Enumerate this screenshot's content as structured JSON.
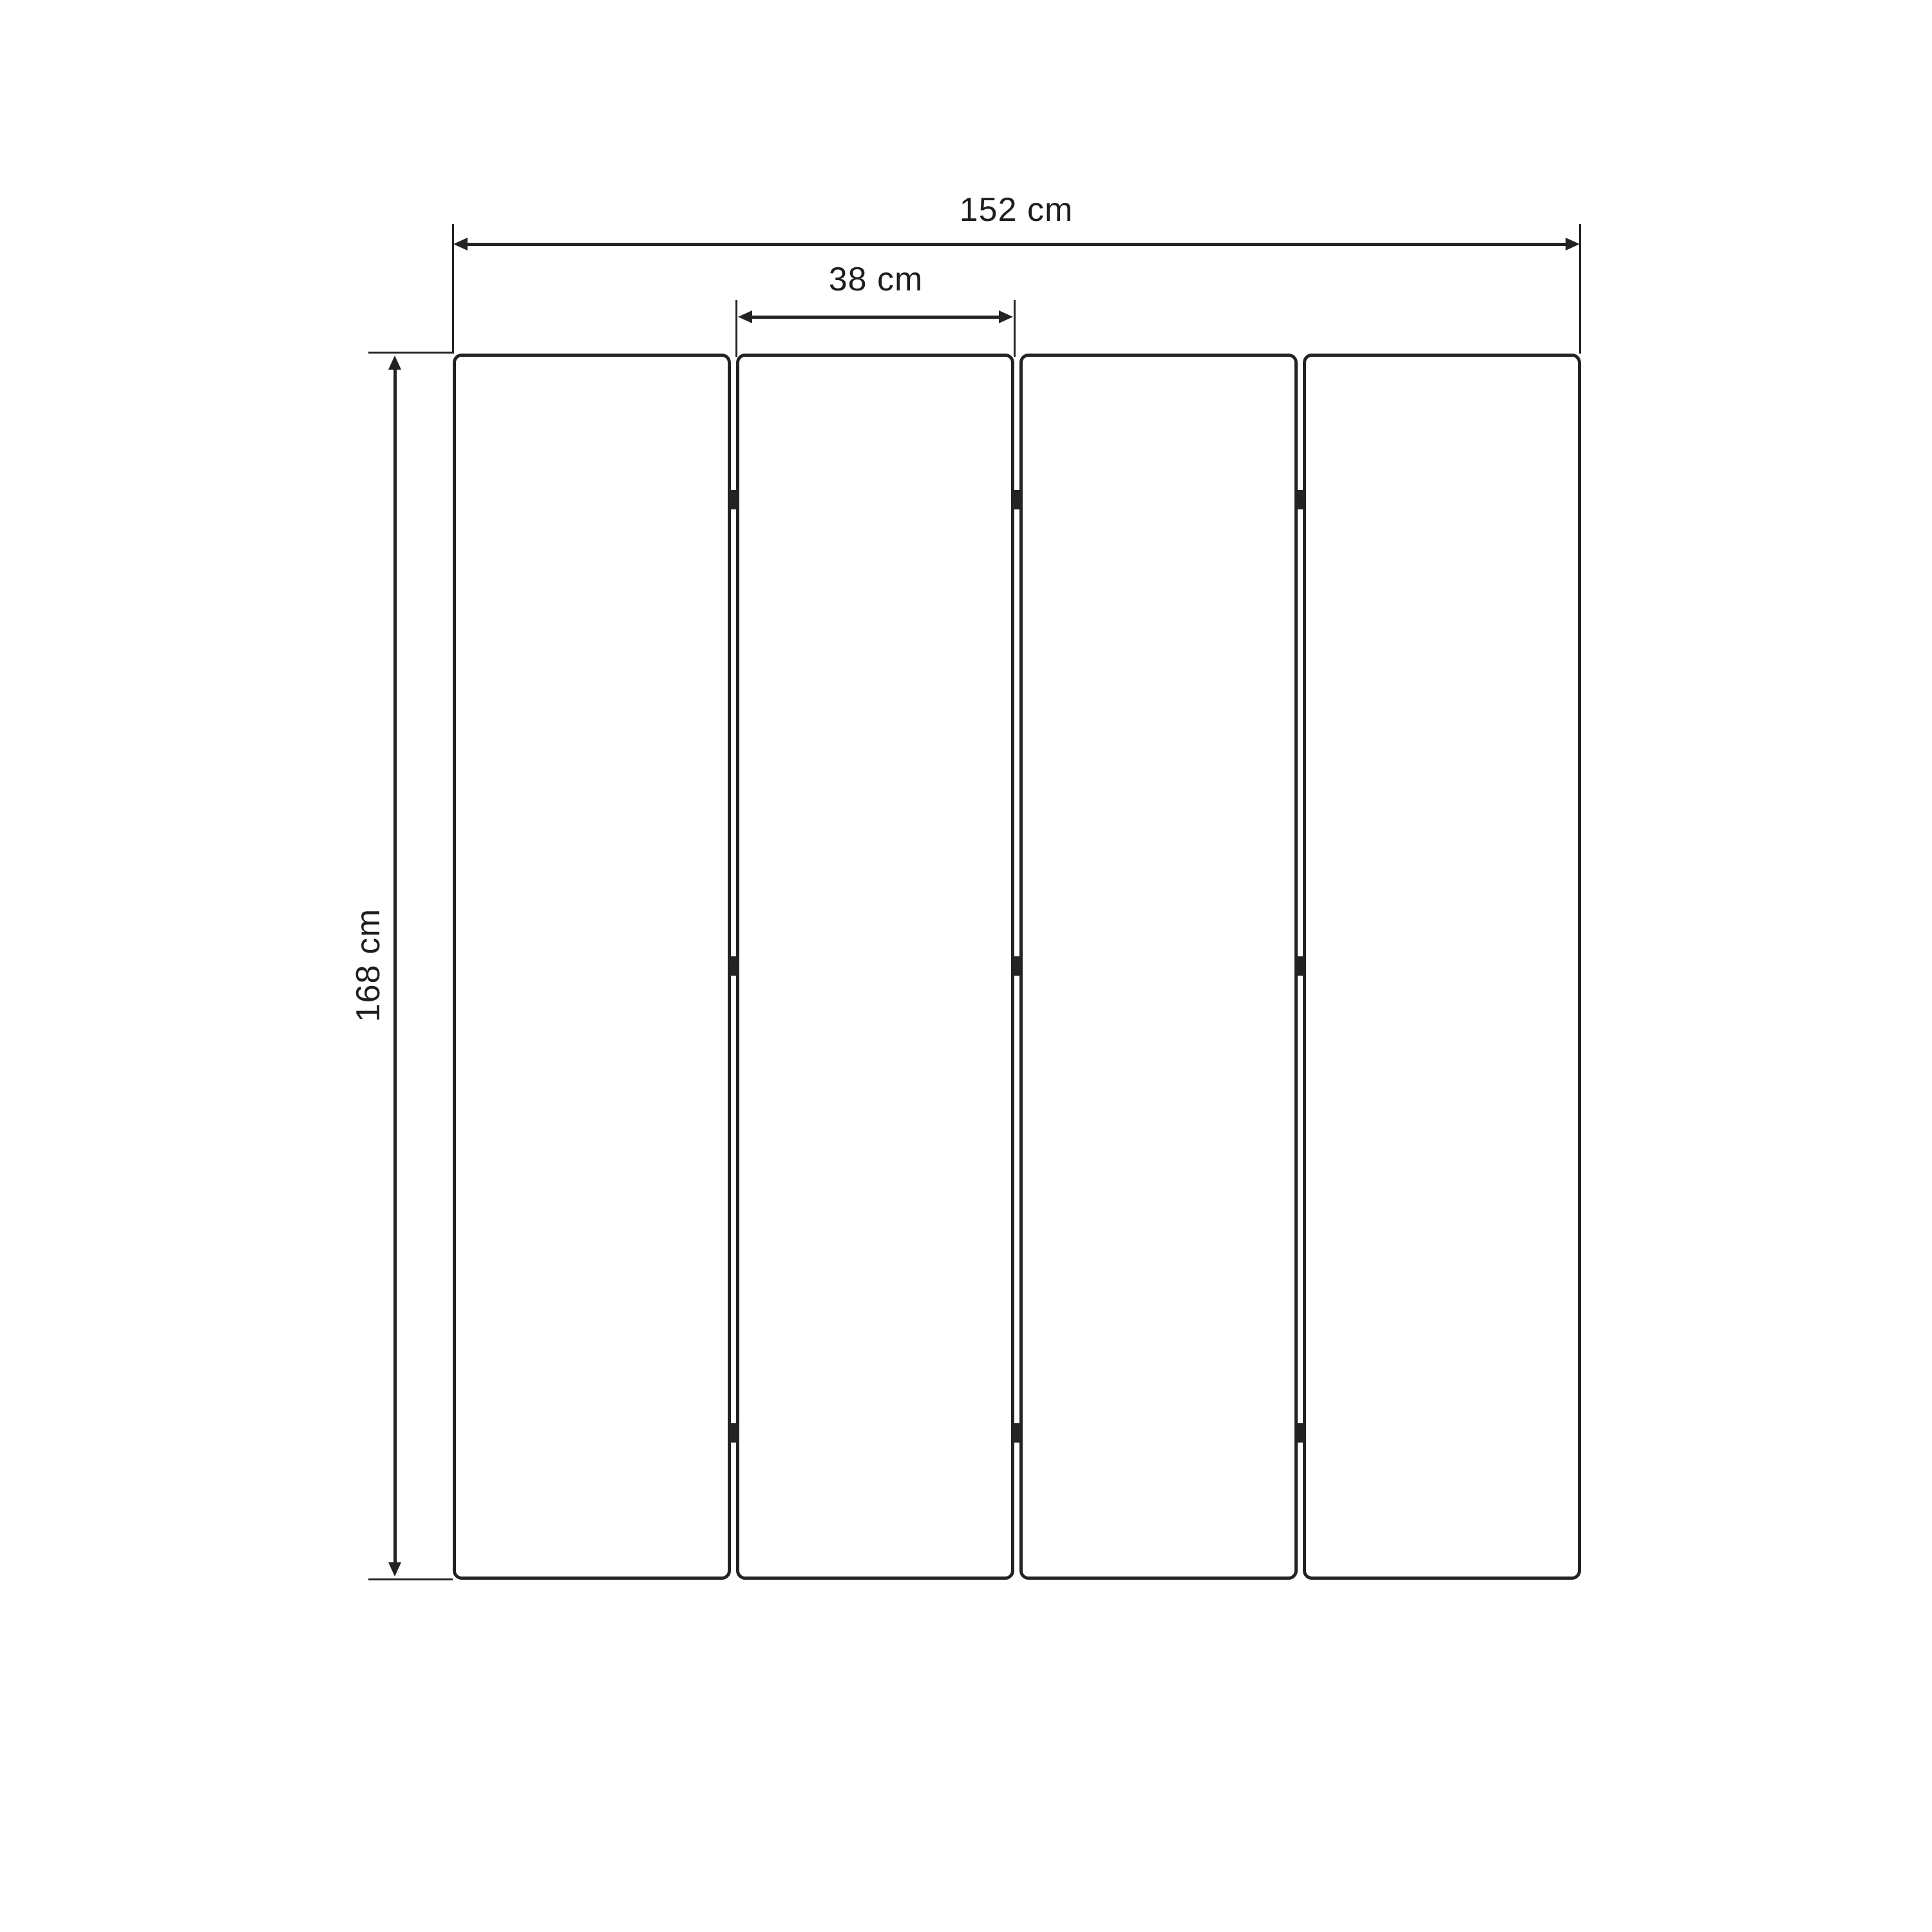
{
  "diagram": {
    "type": "furniture-dimension-drawing",
    "subject": "four-panel folding screen, front view",
    "background_color": "#ffffff",
    "line_color": "#232323",
    "panel_count": 4,
    "hinge_rows": 3,
    "hinge_count": 9,
    "dimensions": {
      "total_width": "152 cm",
      "panel_width": "38 cm",
      "height": "168 cm"
    }
  }
}
